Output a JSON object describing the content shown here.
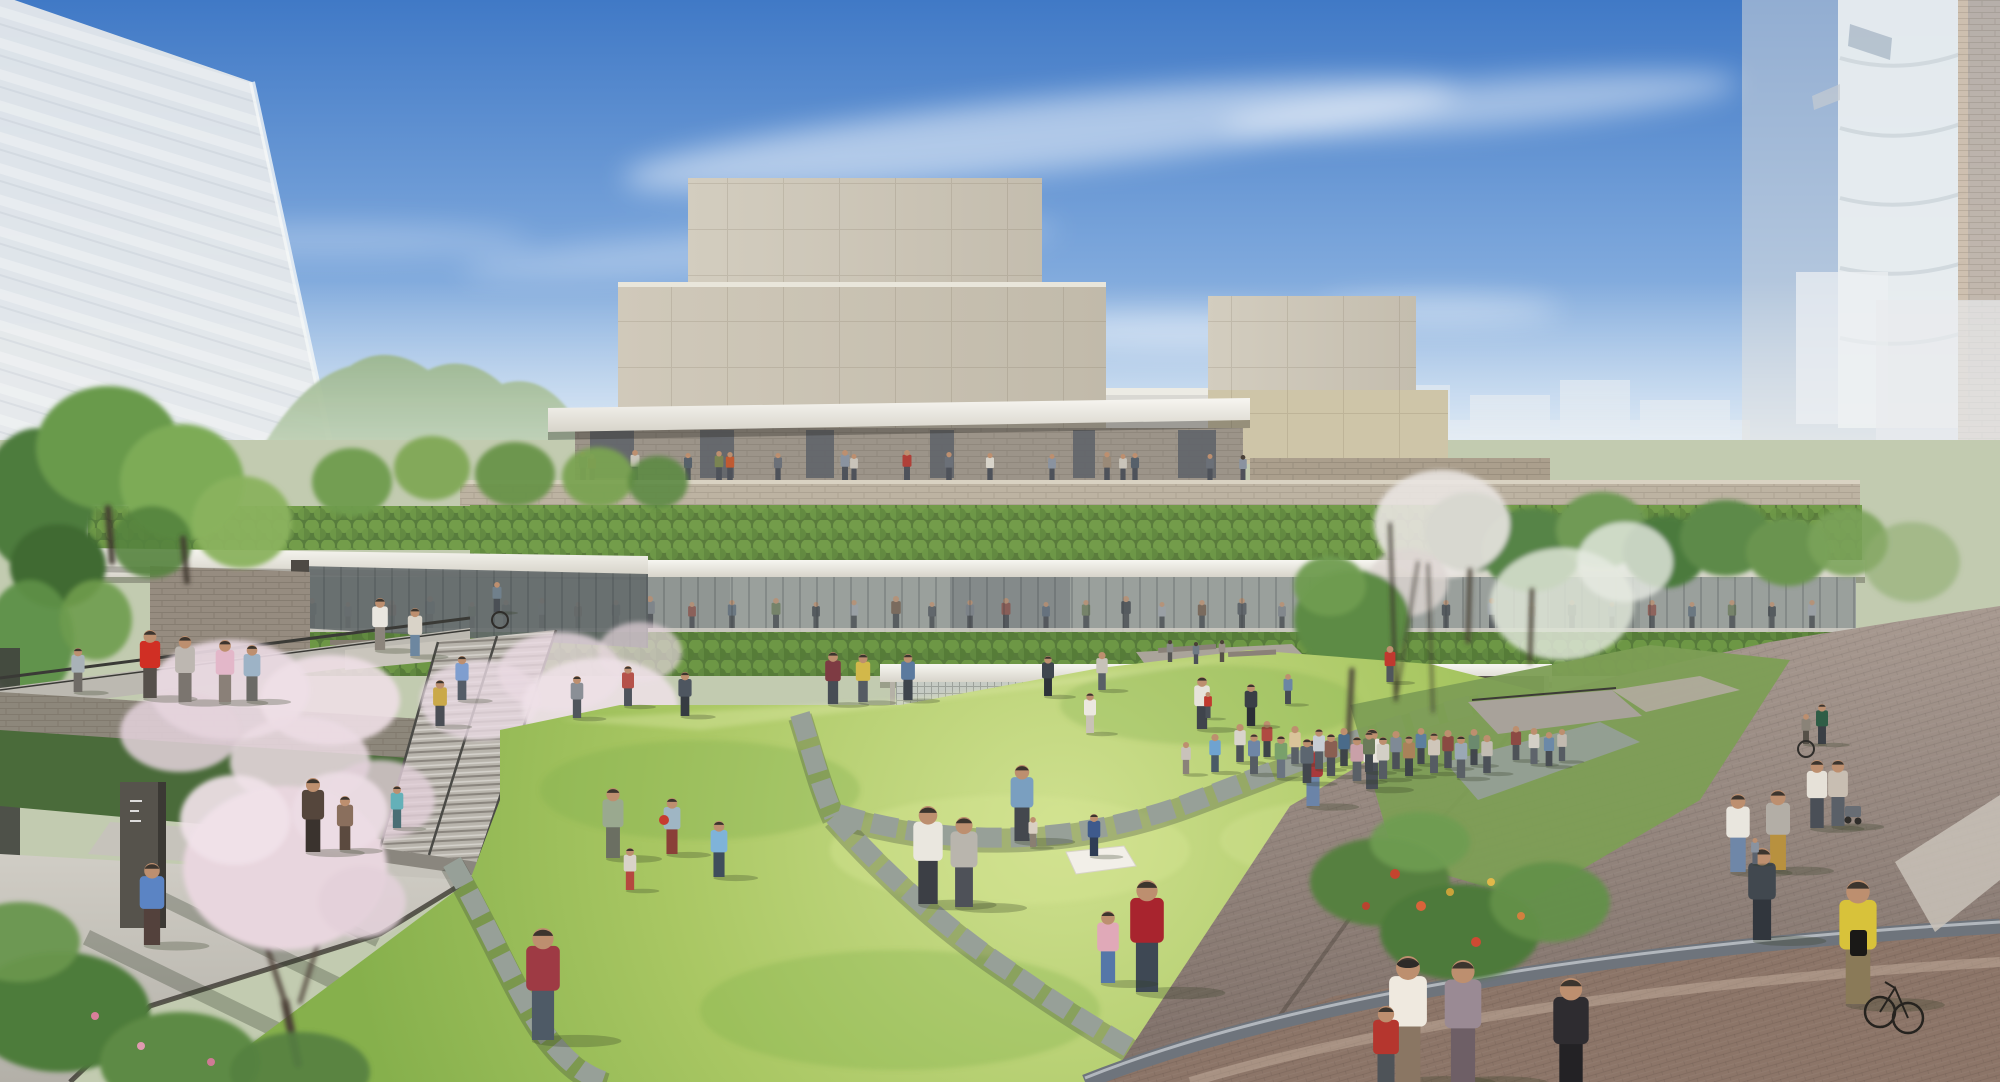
{
  "scene": {
    "type": "architectural-rendering",
    "subject": "aerial spring view of a terraced cultural complex with green roofs around a sunken lawn plaza, crowds of visitors, cherry blossoms, paved promenade and ghosted city context",
    "sky": "clear blue with thin cirrus clouds",
    "palette": {
      "sky_top": "#4079c6",
      "sky_horizon": "#ecf3f8",
      "facade_stone": "#cbc4b4",
      "canopy_white": "#f4f3ee",
      "hedge_green": "#5a7c3c",
      "roof_green": "#577b3b",
      "lawn_bright": "#aecb66",
      "lawn_deep": "#86b04c",
      "path_stone": "#97a098",
      "plaza_paver": "#95847b",
      "plaza_brick": "#8c7568",
      "blossom_pink": "#e8d6de",
      "tree_green": "#699a4c",
      "ghost_building": "#e6e9eb",
      "mountain": "#9db790"
    }
  },
  "people": {
    "palette_silhouettes": [
      "#4e545c",
      "#7a8088",
      "#8a5048",
      "#5c6b7a",
      "#6b7a5a",
      "#3f444b",
      "#9aa0a8",
      "#705a4a"
    ],
    "upper_terrace": {
      "feet_y": 480,
      "bottom": "#4e525a",
      "items": [
        [
          583,
          28,
          "#6b7078"
        ],
        [
          592,
          26,
          "#9a5a4a"
        ],
        [
          635,
          30,
          "#c9c4ba"
        ],
        [
          688,
          27,
          "#56606a"
        ],
        [
          719,
          29,
          "#7a8452"
        ],
        [
          730,
          28,
          "#c05a32"
        ],
        [
          778,
          27,
          "#6b7078"
        ],
        [
          845,
          30,
          "#8a93a0"
        ],
        [
          854,
          26,
          "#c9c4ba"
        ],
        [
          907,
          30,
          "#b04038"
        ],
        [
          949,
          28,
          "#6b7078"
        ],
        [
          990,
          27,
          "#d8d4ca"
        ],
        [
          1052,
          26,
          "#8a93a0"
        ],
        [
          1107,
          28,
          "#9a8a78"
        ],
        [
          1123,
          26,
          "#c9c4ba"
        ],
        [
          1135,
          27,
          "#56606a"
        ],
        [
          1210,
          26,
          "#6b7078"
        ],
        [
          1243,
          25,
          "#8a93a0"
        ]
      ]
    },
    "glazed_walkway": {
      "feet_y": 628,
      "bottom": "#44484e",
      "items": [
        [
          312,
          30
        ],
        [
          348,
          26
        ],
        [
          392,
          28
        ],
        [
          430,
          32
        ],
        [
          472,
          26
        ],
        [
          506,
          28
        ],
        [
          542,
          30
        ],
        [
          578,
          26
        ],
        [
          616,
          28
        ],
        [
          650,
          32
        ],
        [
          692,
          26
        ],
        [
          732,
          28
        ],
        [
          776,
          30
        ],
        [
          816,
          26
        ],
        [
          854,
          28
        ],
        [
          896,
          32
        ],
        [
          932,
          26
        ],
        [
          970,
          28
        ],
        [
          1006,
          30
        ],
        [
          1046,
          26
        ],
        [
          1086,
          28
        ],
        [
          1126,
          32
        ],
        [
          1162,
          26
        ],
        [
          1202,
          28
        ],
        [
          1242,
          30
        ],
        [
          1282,
          26
        ],
        [
          1322,
          28
        ],
        [
          1362,
          32
        ],
        [
          1402,
          26
        ],
        [
          1446,
          28
        ],
        [
          1492,
          30
        ],
        [
          1532,
          26
        ],
        [
          1572,
          28
        ],
        [
          1612,
          26
        ],
        [
          1652,
          28
        ],
        [
          1692,
          26
        ],
        [
          1732,
          28
        ],
        [
          1772,
          26
        ],
        [
          1812,
          28
        ]
      ]
    },
    "figures": [
      [
        78,
        692,
        44,
        "#a9b2b8",
        "#6f6b66"
      ],
      [
        150,
        698,
        68,
        "#d02f24",
        "#56504b"
      ],
      [
        185,
        702,
        66,
        "#bdb7b1",
        "#7b756f"
      ],
      [
        225,
        702,
        62,
        "#e3b7c9",
        "#8a8078"
      ],
      [
        252,
        701,
        56,
        "#9db3c6",
        "#6b6a66"
      ],
      [
        380,
        650,
        52,
        "#e9e6df",
        "#8c857c"
      ],
      [
        415,
        656,
        48,
        "#d9d3c8",
        "#6d87a0"
      ],
      [
        497,
        612,
        30,
        "#70808c",
        "#4a4f55"
      ],
      [
        440,
        726,
        46,
        "#caa94a",
        "#4a4e55"
      ],
      [
        462,
        700,
        44,
        "#7f9ecf",
        "#555d68"
      ],
      [
        313,
        852,
        74,
        "#55463c",
        "#3a332e"
      ],
      [
        345,
        850,
        54,
        "#8a6f5d",
        "#5b4a3f"
      ],
      [
        397,
        828,
        42,
        "#64b0b8",
        "#4a6e74"
      ],
      [
        152,
        945,
        82,
        "#5b84c4",
        "#53413c"
      ],
      [
        543,
        1040,
        112,
        "#9e3a44",
        "#4e5a66"
      ],
      [
        613,
        858,
        70,
        "#9aa98f",
        "#6b6f62"
      ],
      [
        630,
        890,
        42,
        "#d9d3c9",
        "#b5483f"
      ],
      [
        672,
        854,
        56,
        "#9fb6c4",
        "#8a4038"
      ],
      [
        719,
        877,
        56,
        "#7fb3d9",
        "#3f4e5c"
      ],
      [
        928,
        904,
        98,
        "#eae7df",
        "#3c3f45"
      ],
      [
        964,
        907,
        90,
        "#b9b5ad",
        "#4e5158"
      ],
      [
        1022,
        841,
        76,
        "#7a9fc0",
        "#44484e"
      ],
      [
        1033,
        847,
        30,
        "#d9cfc2",
        "#8a7f72"
      ],
      [
        1094,
        856,
        42,
        "#3e5a8c",
        "#2f3d55"
      ],
      [
        1147,
        992,
        112,
        "#a8242e",
        "#3e4854"
      ],
      [
        1108,
        983,
        72,
        "#e0a9b8",
        "#5577a8"
      ],
      [
        1090,
        733,
        40,
        "#ece8e0",
        "#c9c2b6"
      ],
      [
        1186,
        774,
        32,
        "#c9c2ba",
        "#8a8279"
      ],
      [
        1215,
        772,
        38,
        "#6fa3d0",
        "#4a5a66"
      ],
      [
        1202,
        729,
        52,
        "#e6e2da",
        "#3f444c"
      ],
      [
        1313,
        806,
        66,
        "#a83a3c",
        "#6b84a8"
      ],
      [
        1372,
        789,
        60,
        "#e8e4dc",
        "#494e56"
      ],
      [
        1240,
        762,
        38,
        "#d8d4cb",
        "#4c5158"
      ],
      [
        1254,
        774,
        40,
        "#6f86a6",
        "#565c63"
      ],
      [
        1267,
        757,
        36,
        "#b04a42",
        "#3e4448"
      ],
      [
        1281,
        778,
        42,
        "#79a06b",
        "#6b7480"
      ],
      [
        1295,
        764,
        38,
        "#d9c49a",
        "#5a6066"
      ],
      [
        1307,
        783,
        44,
        "#5c6670",
        "#42474d"
      ],
      [
        1319,
        769,
        40,
        "#c7cdd4",
        "#565c63"
      ],
      [
        1331,
        776,
        42,
        "#8a5f52",
        "#4c5158"
      ],
      [
        1344,
        766,
        38,
        "#4a6b8a",
        "#3e4448"
      ],
      [
        1357,
        781,
        44,
        "#c9a0a8",
        "#5a6066"
      ],
      [
        1369,
        772,
        40,
        "#6b7a5a",
        "#42474d"
      ],
      [
        1383,
        779,
        42,
        "#d3cfc6",
        "#565c63"
      ],
      [
        1396,
        769,
        38,
        "#7f8a96",
        "#4c5158"
      ],
      [
        1409,
        776,
        40,
        "#a9825a",
        "#3e4448"
      ],
      [
        1421,
        764,
        36,
        "#5d7f9e",
        "#42474d"
      ],
      [
        1434,
        773,
        40,
        "#cfc6ba",
        "#565c63"
      ],
      [
        1448,
        768,
        38,
        "#8a4a42",
        "#4c5158"
      ],
      [
        1461,
        778,
        42,
        "#9aa8b5",
        "#5a6066"
      ],
      [
        1474,
        765,
        36,
        "#6b8a6e",
        "#42474d"
      ],
      [
        1487,
        773,
        38,
        "#c2bcb2",
        "#4c5158"
      ],
      [
        1390,
        682,
        36,
        "#c0392f",
        "#50565c"
      ],
      [
        1170,
        662,
        22,
        "#8a8a88",
        "#555553"
      ],
      [
        1196,
        664,
        22,
        "#6f7a84",
        "#4c5158"
      ],
      [
        1222,
        662,
        22,
        "#9a9088",
        "#565048"
      ],
      [
        1516,
        760,
        34,
        "#8c4a44",
        "#4e5358"
      ],
      [
        1534,
        764,
        36,
        "#d3cfc6",
        "#5e646b"
      ],
      [
        1549,
        766,
        34,
        "#6b89a8",
        "#474c52"
      ],
      [
        1562,
        761,
        32,
        "#c2bab0",
        "#565c63"
      ],
      [
        1738,
        872,
        78,
        "#e9e6de",
        "#6f87a8"
      ],
      [
        1778,
        870,
        80,
        "#b3aea6",
        "#b8913f"
      ],
      [
        1762,
        940,
        92,
        "#41484f",
        "#31363d"
      ],
      [
        1817,
        828,
        68,
        "#e6e1d8",
        "#4a4f57"
      ],
      [
        1838,
        826,
        66,
        "#c8beb2",
        "#5a6068"
      ],
      [
        1822,
        744,
        40,
        "#2f5d46",
        "#3a3f45"
      ],
      [
        1806,
        744,
        30,
        "#8a8378",
        "#565048"
      ],
      [
        1755,
        864,
        26,
        "#8a93a0",
        "#5c636e"
      ],
      [
        1408,
        1082,
        126,
        "#efe9df",
        "#8a7663"
      ],
      [
        1463,
        1082,
        122,
        "#9a8a94",
        "#6e5f66"
      ],
      [
        1571,
        1096,
        118,
        "#2e2c30",
        "#232225"
      ],
      [
        1858,
        1004,
        124,
        "#d8c23a",
        "#8a7a58"
      ],
      [
        1386,
        1092,
        86,
        "#b5362e",
        "#4e5358"
      ],
      [
        577,
        718,
        42,
        "#8a8f96",
        "#50555c"
      ],
      [
        628,
        706,
        40,
        "#b5524a",
        "#4e545c"
      ],
      [
        685,
        716,
        44,
        "#4e5660",
        "#363b42"
      ],
      [
        833,
        704,
        52,
        "#7e3b43",
        "#474d55"
      ],
      [
        863,
        702,
        48,
        "#d2b84a",
        "#555b63"
      ],
      [
        908,
        700,
        46,
        "#5b7a9e",
        "#3f454d"
      ],
      [
        1048,
        696,
        40,
        "#3f464e",
        "#2e3339"
      ],
      [
        1102,
        690,
        38,
        "#c7c2b8",
        "#595f67"
      ],
      [
        1208,
        718,
        26,
        "#c0392f",
        "#4a5057"
      ],
      [
        1251,
        726,
        42,
        "#3a3f46",
        "#2b2f35"
      ],
      [
        1288,
        704,
        30,
        "#6b86a4",
        "#454b52"
      ]
    ]
  },
  "vegetation": {
    "back": [
      [
        38,
        500,
        56,
        72,
        "#4e7c3c",
        1
      ],
      [
        108,
        448,
        72,
        62,
        "#699a4c",
        1
      ],
      [
        182,
        482,
        62,
        58,
        "#7dab57",
        1
      ],
      [
        58,
        566,
        48,
        42,
        "#3f6b31",
        1
      ],
      [
        242,
        522,
        50,
        46,
        "#8ab25e",
        0.95
      ],
      [
        152,
        542,
        40,
        36,
        "#55833f",
        0.9
      ],
      [
        30,
        640,
        44,
        60,
        "#5d8f46",
        0.95
      ],
      [
        96,
        620,
        36,
        40,
        "#6f9c4e",
        0.9
      ],
      [
        352,
        482,
        40,
        34,
        "#6f9c4e",
        0.95
      ],
      [
        432,
        468,
        38,
        32,
        "#7fa855",
        0.95
      ],
      [
        515,
        474,
        40,
        32,
        "#699348",
        0.95
      ],
      [
        598,
        477,
        36,
        30,
        "#7aa251",
        0.95
      ],
      [
        658,
        482,
        30,
        26,
        "#5d8a42",
        0.9
      ]
    ],
    "mid": [
      [
        1470,
        532,
        46,
        40,
        "#3f6b35",
        1
      ],
      [
        1532,
        550,
        50,
        42,
        "#568447",
        1
      ],
      [
        1602,
        530,
        46,
        38,
        "#6f9a55",
        1
      ],
      [
        1665,
        552,
        42,
        36,
        "#4c7a3e",
        1
      ],
      [
        1726,
        538,
        46,
        38,
        "#5d8a48",
        1
      ],
      [
        1788,
        552,
        42,
        34,
        "#6b9450",
        1
      ],
      [
        1848,
        542,
        40,
        34,
        "#7aa25a",
        0.9
      ],
      [
        1912,
        562,
        48,
        40,
        "#8fae6f",
        0.6
      ],
      [
        1442,
        524,
        68,
        54,
        "#e9e4e1",
        0.9
      ],
      [
        1408,
        582,
        40,
        34,
        "#ddd6d2",
        0.8
      ],
      [
        1562,
        604,
        72,
        56,
        "#dde4d6",
        0.85
      ],
      [
        1625,
        562,
        48,
        40,
        "#e6eae2",
        0.8
      ],
      [
        1352,
        620,
        58,
        50,
        "#5d8b45",
        1
      ],
      [
        1330,
        586,
        36,
        30,
        "#6f9c50",
        0.95
      ],
      [
        230,
        690,
        80,
        50,
        "#e9d9e2",
        0.92
      ],
      [
        330,
        700,
        70,
        45,
        "#eedfe6",
        0.9
      ],
      [
        180,
        732,
        60,
        40,
        "#e4d2dc",
        0.85
      ],
      [
        300,
        762,
        70,
        45,
        "#ecdce4",
        0.85
      ],
      [
        380,
        800,
        55,
        40,
        "#e2d0da",
        0.8
      ],
      [
        480,
        700,
        60,
        40,
        "#e9d9e2",
        0.8
      ],
      [
        560,
        672,
        62,
        40,
        "#eadae2",
        0.8
      ],
      [
        640,
        652,
        42,
        30,
        "#e4d4dc",
        0.7
      ],
      [
        600,
        706,
        78,
        48,
        "#efe2e8",
        0.85
      ]
    ],
    "front": [
      [
        285,
        868,
        102,
        82,
        "#e8d6de",
        1
      ],
      [
        235,
        820,
        55,
        45,
        "#f0e2e8",
        0.92
      ],
      [
        340,
        812,
        48,
        40,
        "#ecdce4",
        0.92
      ],
      [
        362,
        902,
        44,
        36,
        "#e2d0da",
        0.88
      ],
      [
        60,
        1012,
        90,
        60,
        "#4e7c3a",
        1
      ],
      [
        180,
        1062,
        80,
        50,
        "#5d8a44",
        1
      ],
      [
        20,
        942,
        60,
        40,
        "#69964d",
        0.95
      ],
      [
        300,
        1072,
        70,
        40,
        "#548040",
        0.9
      ],
      [
        1380,
        882,
        70,
        44,
        "#57803f",
        1
      ],
      [
        1460,
        932,
        80,
        48,
        "#4e7a3a",
        1
      ],
      [
        1550,
        902,
        60,
        40,
        "#639048",
        0.95
      ],
      [
        1420,
        842,
        50,
        30,
        "#6f9c52",
        0.9
      ]
    ],
    "trunks": [
      [
        285,
        1002,
        298,
        1064,
        8,
        "#4a3e34"
      ],
      [
        262,
        932,
        285,
        1002,
        5,
        "#554840"
      ],
      [
        322,
        930,
        300,
        1002,
        4,
        "#554840"
      ],
      [
        1352,
        670,
        1348,
        748,
        5,
        "#4a4238"
      ],
      [
        1470,
        570,
        1468,
        642,
        4,
        "#473f36"
      ],
      [
        1532,
        590,
        1530,
        662,
        4,
        "#473f36"
      ],
      [
        108,
        508,
        112,
        562,
        6,
        "#3f382f"
      ],
      [
        183,
        538,
        187,
        582,
        5,
        "#3f382f"
      ],
      [
        1396,
        700,
        1390,
        524,
        3,
        "#3a342c"
      ],
      [
        1396,
        700,
        1418,
        562,
        2,
        "#3a342c"
      ],
      [
        1433,
        712,
        1428,
        564,
        2,
        "#3a342c"
      ]
    ],
    "flowers": [
      [
        1395,
        874,
        5,
        "#c4452f"
      ],
      [
        1421,
        906,
        5,
        "#d8633a"
      ],
      [
        1450,
        892,
        4,
        "#c9a23a"
      ],
      [
        1476,
        942,
        5,
        "#cf4a33"
      ],
      [
        1521,
        916,
        4,
        "#d2803f"
      ],
      [
        1366,
        906,
        4,
        "#b9432f"
      ],
      [
        1491,
        882,
        4,
        "#e0b84a"
      ],
      [
        95,
        1016,
        4,
        "#d87f9a"
      ],
      [
        141,
        1046,
        4,
        "#e09ab0"
      ],
      [
        211,
        1062,
        4,
        "#cf7a95"
      ]
    ]
  },
  "props": {
    "picnic_blanket": "1066,852 1124,846 1136,866 1076,874",
    "benches": [
      [
        1158,
        648,
        58,
        5,
        -4
      ],
      [
        1228,
        652,
        48,
        5,
        -3
      ]
    ],
    "wheelchairs": [
      [
        500,
        620,
        8
      ],
      [
        1806,
        749,
        8
      ]
    ],
    "bike": {
      "w1": [
        1880,
        1012,
        15
      ],
      "w2": [
        1908,
        1018,
        15
      ]
    },
    "ball": [
      664,
      820,
      5
    ],
    "backpack": [
      1850,
      930,
      17,
      26,
      "#1a1917"
    ],
    "stroller": [
      1845,
      806,
      16,
      11,
      "#686d74"
    ],
    "hat": [
      1408,
      964,
      11,
      4,
      "#2e2a28"
    ]
  }
}
